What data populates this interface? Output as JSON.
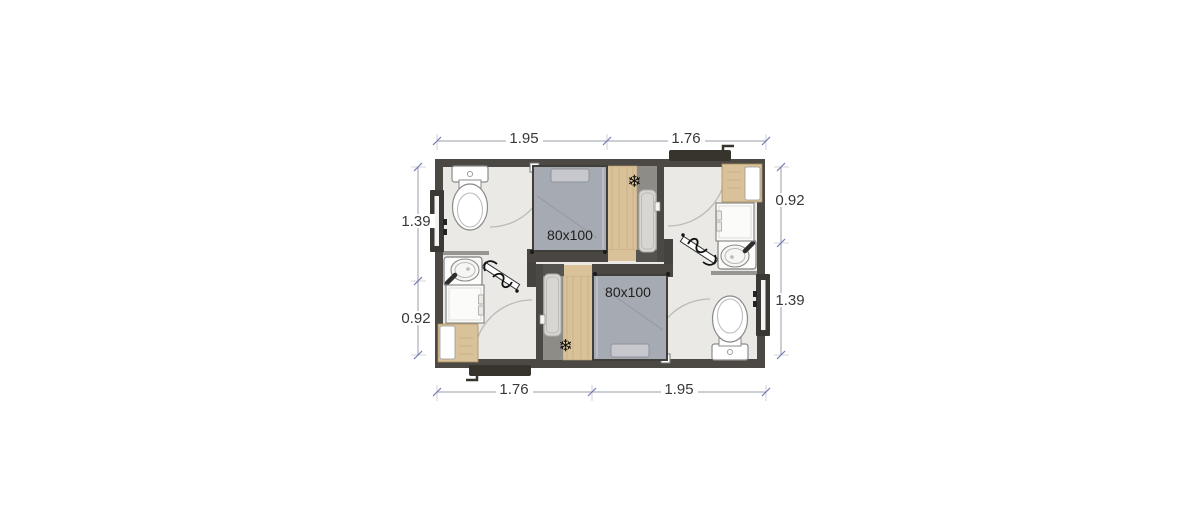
{
  "floor_plan": {
    "description": "Mirrored twin-unit floor plan with two beds, two bathrooms, two entries",
    "units": [
      {
        "id": "unit-top",
        "bed_label": "80x100",
        "ac_icon": "❄"
      },
      {
        "id": "unit-bottom",
        "bed_label": "80x100",
        "ac_icon": "❄"
      }
    ],
    "dimensions": {
      "top": [
        {
          "value": "1.95"
        },
        {
          "value": "1.76"
        }
      ],
      "bottom": [
        {
          "value": "1.76"
        },
        {
          "value": "1.95"
        }
      ],
      "left": [
        {
          "value": "1.39"
        },
        {
          "value": "0.92"
        }
      ],
      "right": [
        {
          "value": "0.92"
        },
        {
          "value": "1.39"
        }
      ]
    },
    "colors": {
      "wall": "#4c4944",
      "floor": "#eae9e6",
      "wood": "#d9c29a",
      "tile": "#8d8c87",
      "bed": "#a6aab2",
      "shower_tray": "#d7d6d2",
      "fixture": "#ffffff",
      "dimension_text": "#383838"
    }
  }
}
